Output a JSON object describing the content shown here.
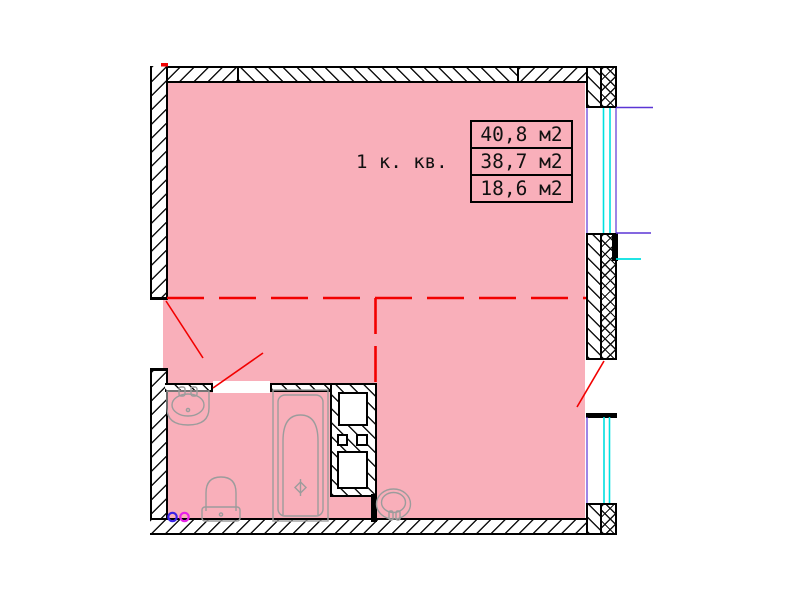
{
  "room": {
    "label": "1 к. кв."
  },
  "area_table": {
    "rows": [
      "40,8 м2",
      "38,7 м2",
      "18,6 м2"
    ]
  },
  "colors": {
    "floor_pink": "#F9AFBA",
    "annotation_red": "#F20000",
    "glazing_cyan": "#00E0E0",
    "jamb_purple": "#5B35D5",
    "fixture_gray": "#9C9C9C",
    "wall_black": "#000000",
    "riser_blue": "#3A23E8",
    "riser_magenta": "#E822E8"
  }
}
